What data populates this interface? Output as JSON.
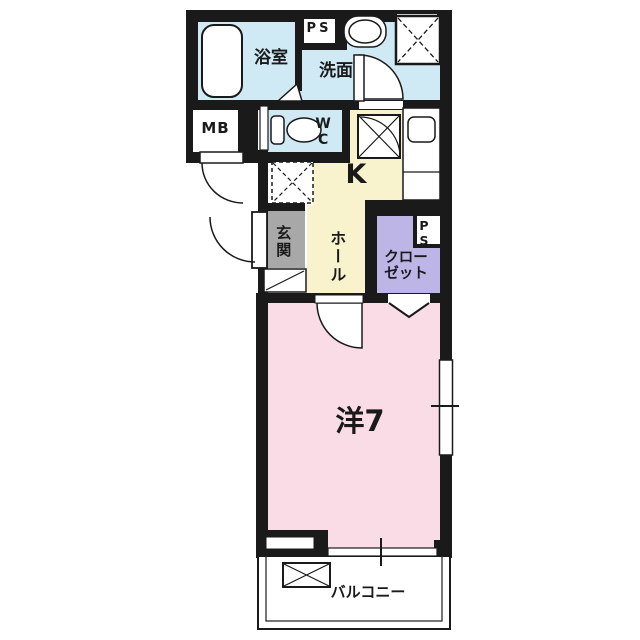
{
  "floor_plan": {
    "labels": {
      "bathroom": "浴室",
      "pipe_space_top": "PS",
      "washroom": "洗面",
      "wc": "WC",
      "meter_box": "MB",
      "kitchen": "K",
      "entrance": "玄関",
      "hall": "ホール",
      "closet_line1": "クロー",
      "closet_line2": "ゼット",
      "pipe_space_closet": "PS",
      "western_room": "洋7",
      "balcony": "バルコニー"
    },
    "colors": {
      "wall": "#1a1a1a",
      "wet_area": "#cfe9f5",
      "kitchen_hall": "#f9f3cd",
      "entrance": "#a8a8a8",
      "closet": "#bdb5e6",
      "room": "#fadce6",
      "fixture_fill": "#ffffff"
    }
  }
}
